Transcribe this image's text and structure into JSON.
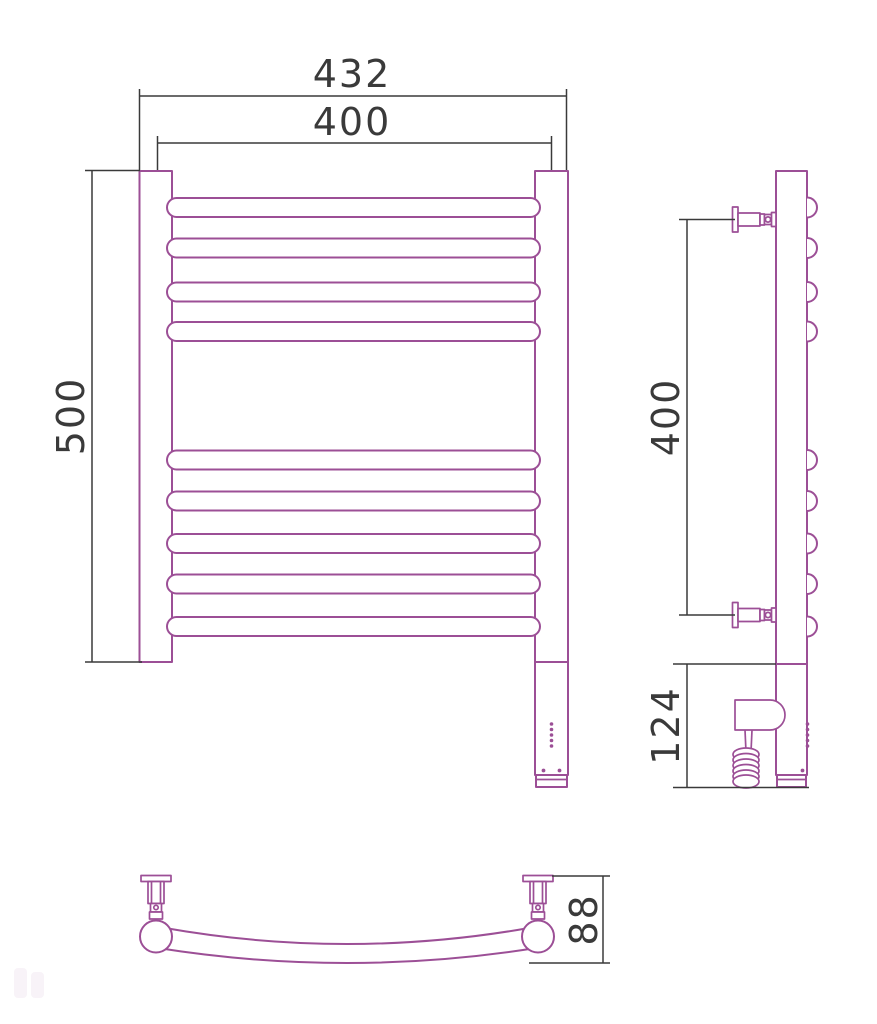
{
  "drawing": {
    "description": "Technical dimension drawing of a ladder-style heated towel rail with electric heating element: front view, side view and bottom view",
    "colors": {
      "product_outline": "#9c4f96",
      "dimension_lines": "#3a3a3a",
      "background": "#ffffff"
    },
    "labels": {
      "dim_overall_width": "432",
      "dim_rail_width": "400",
      "dim_height": "500",
      "dim_mount_spacing": "400",
      "dim_heater_section": "124",
      "dim_depth": "88"
    },
    "front_view": {
      "rung_count": 9,
      "rung_groups": [
        4,
        5
      ],
      "rung_centers_px": [
        207.5,
        248,
        292,
        331.5,
        460,
        501,
        543.5,
        584,
        626.5
      ],
      "rung_half_thickness_px": 9.5,
      "led_dots_y_px": [
        724,
        729.5,
        735,
        740.5,
        746
      ]
    },
    "side_view": {
      "bump_count": 9,
      "mount_centers_y_px": [
        219.5,
        615
      ]
    },
    "bottom_view": {
      "mount_centers_x_px": [
        156,
        538
      ]
    }
  }
}
